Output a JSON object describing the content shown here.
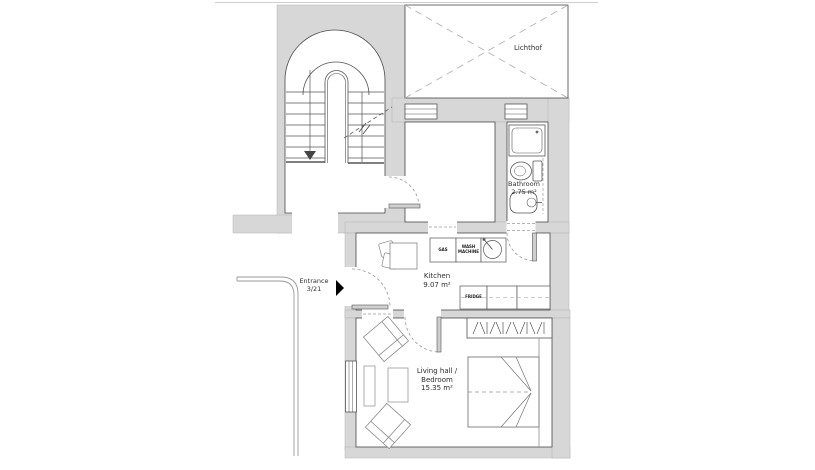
{
  "plan": {
    "colors": {
      "wall_fill": "#d7d7d7",
      "outline": "#4a4a4a",
      "furniture": "#8a8a8a",
      "dashed": "#a5a5a5",
      "entrance_arrow": "#000000"
    },
    "rooms": {
      "lichthof": {
        "label": "Lichthof"
      },
      "bathroom": {
        "label": "Bathroom",
        "area": "2.75 m²"
      },
      "kitchen": {
        "label": "Kitchen",
        "area": "9.07 m²"
      },
      "living": {
        "label_line1": "Living hall /",
        "label_line2": "Bedroom",
        "area": "15.35 m²"
      }
    },
    "entrance": {
      "label": "Entrance",
      "unit": "3/21"
    },
    "appliances": {
      "stove": "GAS",
      "washer_line1": "WASH",
      "washer_line2": "MACHINE",
      "fridge": "FRIDGE"
    }
  }
}
